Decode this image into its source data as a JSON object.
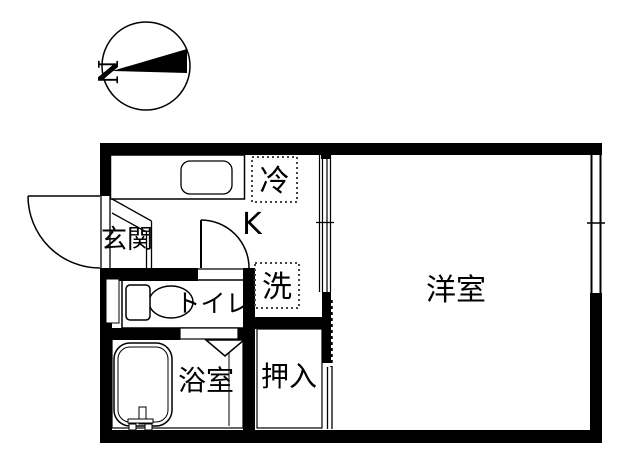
{
  "compass": {
    "north_label": "N"
  },
  "labels": {
    "genkan": "玄関",
    "kitchen": "K",
    "fridge": "冷",
    "laundry": "洗",
    "toilet": "トイレ",
    "bath": "浴室",
    "closet": "押入",
    "western_room": "洋室"
  },
  "colors": {
    "wall": "#000000",
    "line": "#000000",
    "dotted_box": "#444444",
    "background": "#ffffff"
  }
}
